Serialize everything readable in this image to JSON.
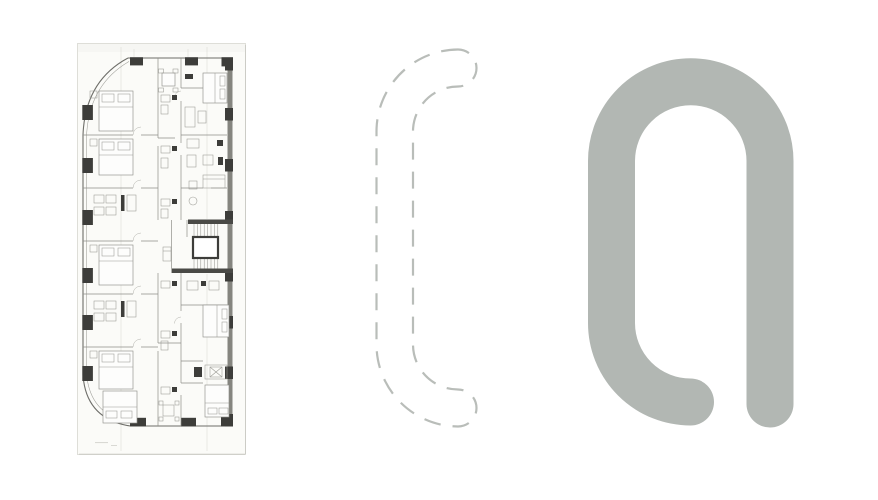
{
  "canvas": {
    "width": 878,
    "height": 500,
    "background": "#ffffff"
  },
  "floor_plan": {
    "name": "floor-plan-scan",
    "paper_color": "#fbfbf8",
    "wall_color": "#6e6e69",
    "line_color": "#8f8f89",
    "dark_color": "#3d3d3a",
    "right_wall_color": "#85857f"
  },
  "outline": {
    "name": "dashed-plan-outline",
    "stroke_color": "#b9bdb9"
  },
  "logo": {
    "name": "solid-logo-mark",
    "fill_color": "#b2b7b3"
  }
}
